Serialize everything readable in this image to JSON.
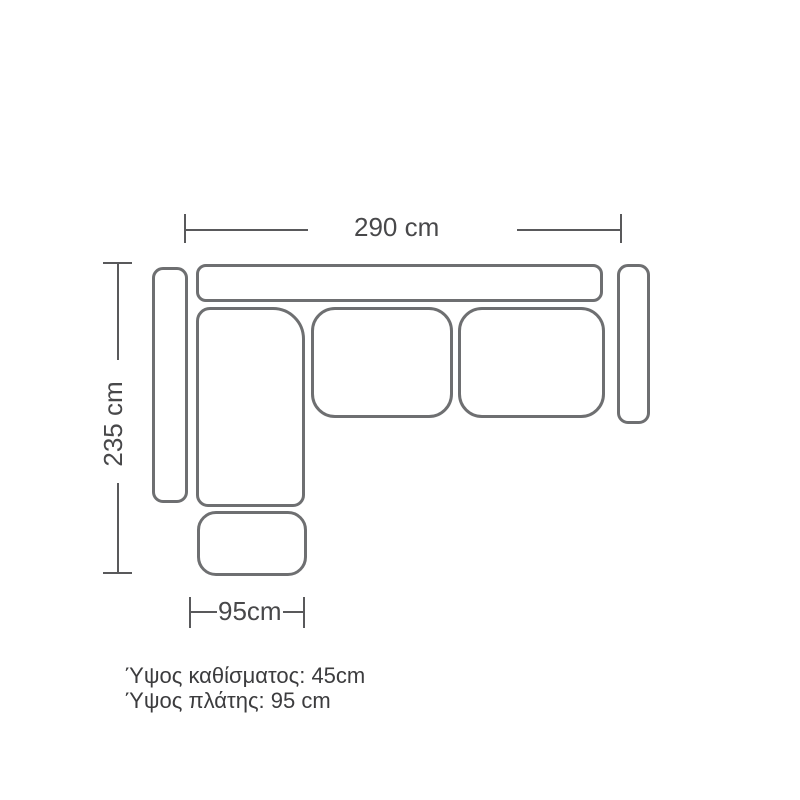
{
  "diagram": {
    "type": "sofa-top-view-dimension-drawing",
    "dimensions": {
      "width_label": "290 cm",
      "depth_label": "235 cm",
      "chaise_width_label": "95cm"
    },
    "notes": {
      "seat_height": "Ύψος καθίσματος: 45cm",
      "back_height": "Ύψος πλάτης: 95 cm"
    },
    "parts": [
      "backrest",
      "left-armrest",
      "right-armrest",
      "chaise-seat",
      "middle-seat-cushion",
      "right-seat-cushion",
      "ottoman"
    ],
    "colors": {
      "background": "#ffffff",
      "outline": "#6e6f71",
      "dimension_line": "#59595b",
      "dimension_text": "#48484a",
      "note_text": "#3c3c3e"
    }
  }
}
